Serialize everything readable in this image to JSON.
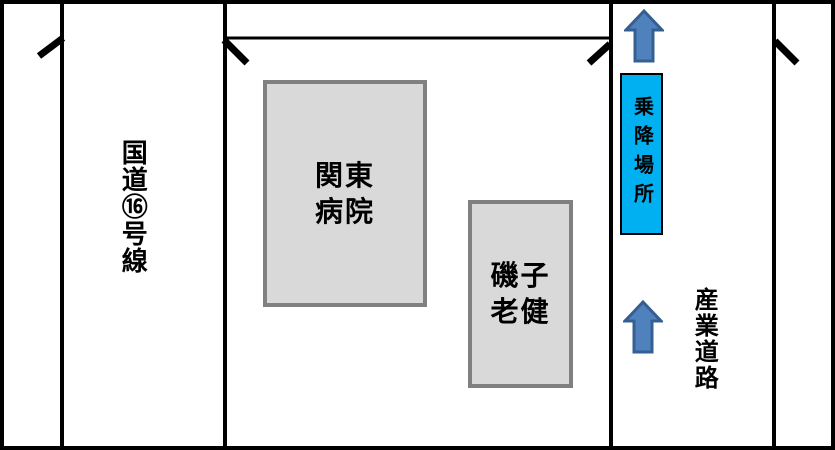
{
  "roads": {
    "route16": {
      "label": "国道⑯号線"
    },
    "sangyo": {
      "label": "産業道路"
    }
  },
  "buildings": {
    "kanto_hospital": {
      "label": "関東\n病院",
      "fill": "#d9d9d9",
      "border_color": "#808080"
    },
    "isogo_roken": {
      "label": "磯子\n老健",
      "fill": "#d9d9d9",
      "border_color": "#808080"
    }
  },
  "boarding_point": {
    "label": "乗降場所",
    "fill": "#00b0f0",
    "border_color": "#000000"
  },
  "direction_arrows": {
    "count": 2,
    "direction": "up",
    "fill": "#4f81bd",
    "stroke": "#365f91"
  },
  "road_line_color": "#000000"
}
